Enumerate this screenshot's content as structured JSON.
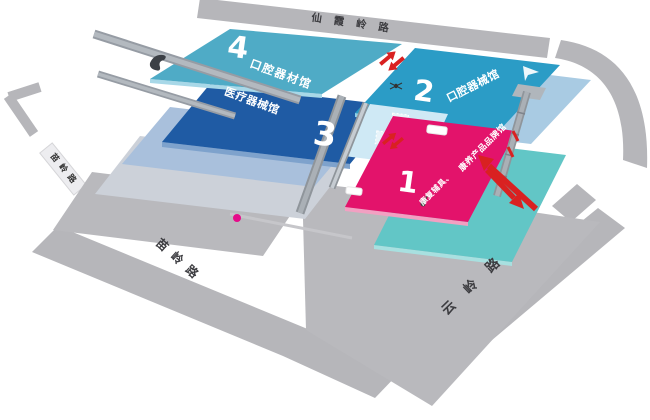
{
  "map_title": "exhibition-site-map",
  "roads": {
    "top_road": {
      "label": "仙霞岭路"
    },
    "west_road_sign": {
      "label": "苗岭路"
    },
    "southwest_road": {
      "label": "苗岭路"
    },
    "southeast_road": {
      "label": "云岭路"
    }
  },
  "halls": {
    "hall_4": {
      "number": "4",
      "name": "口腔器材馆",
      "color": "#4fabc6"
    },
    "hall_3": {
      "number": "3",
      "name": "医疗器械馆",
      "color": "#1f5ba4"
    },
    "hall_2": {
      "number": "2",
      "name": "口腔器械馆",
      "color": "#2b9cc6"
    },
    "hall_1": {
      "number": "1",
      "name": "康复辅具、康养产品品牌馆",
      "name_line1": "康复辅具、",
      "name_line2": "康养产品品牌馆",
      "color": "#e3136b"
    }
  },
  "colors": {
    "road_gray": "#b6b6ba",
    "plaza_gray": "#b9b9bd",
    "hall4_teal": "#4fabc6",
    "hall3_blue": "#1f5ba4",
    "hall2_cyan": "#2b9cc6",
    "hall1_pink": "#e3136b",
    "deck_light_blue": "#a9cbe3",
    "deck_periwinkle": "#a9c0dc",
    "deck_teal": "#62c6c6",
    "atrium_blue": "#cfe9f5",
    "arrow_red": "#d92121",
    "location_dot": "#e60b8a"
  }
}
